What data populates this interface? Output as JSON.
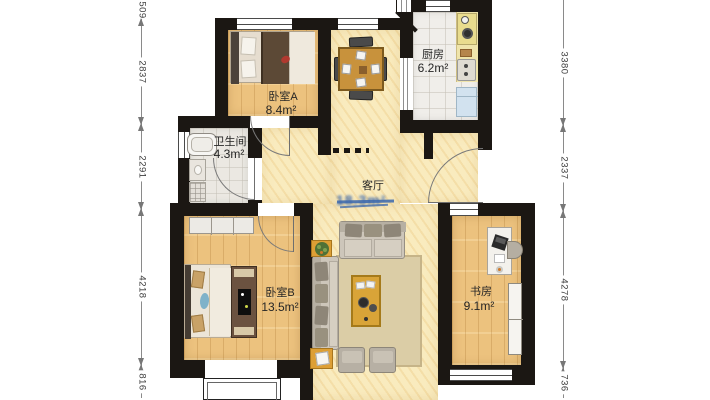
{
  "rooms": {
    "bedroomA": {
      "name": "卧室A",
      "area": "8.4m²"
    },
    "kitchen": {
      "name": "厨房",
      "area": "6.2m²"
    },
    "bathroom": {
      "name": "卫生间",
      "area": "4.3m²"
    },
    "living": {
      "name": "客厅",
      "area_obscured": "18.3m²"
    },
    "bedroomB": {
      "name": "卧室B",
      "area": "13.5m²"
    },
    "study": {
      "name": "书房",
      "area": "9.1m²"
    }
  },
  "dimensions": {
    "left": [
      "509",
      "2837",
      "2291",
      "4218",
      "816"
    ],
    "right": [
      "3380",
      "2337",
      "4278",
      "736"
    ]
  },
  "colors": {
    "wall": "#1b1713",
    "wood_floor": "#ecc27e",
    "living_floor": "#f9ebbe",
    "tile_floor": "#f0eeea",
    "accent_gold": "#dca73f",
    "obscured_text": "#3a67ad"
  }
}
